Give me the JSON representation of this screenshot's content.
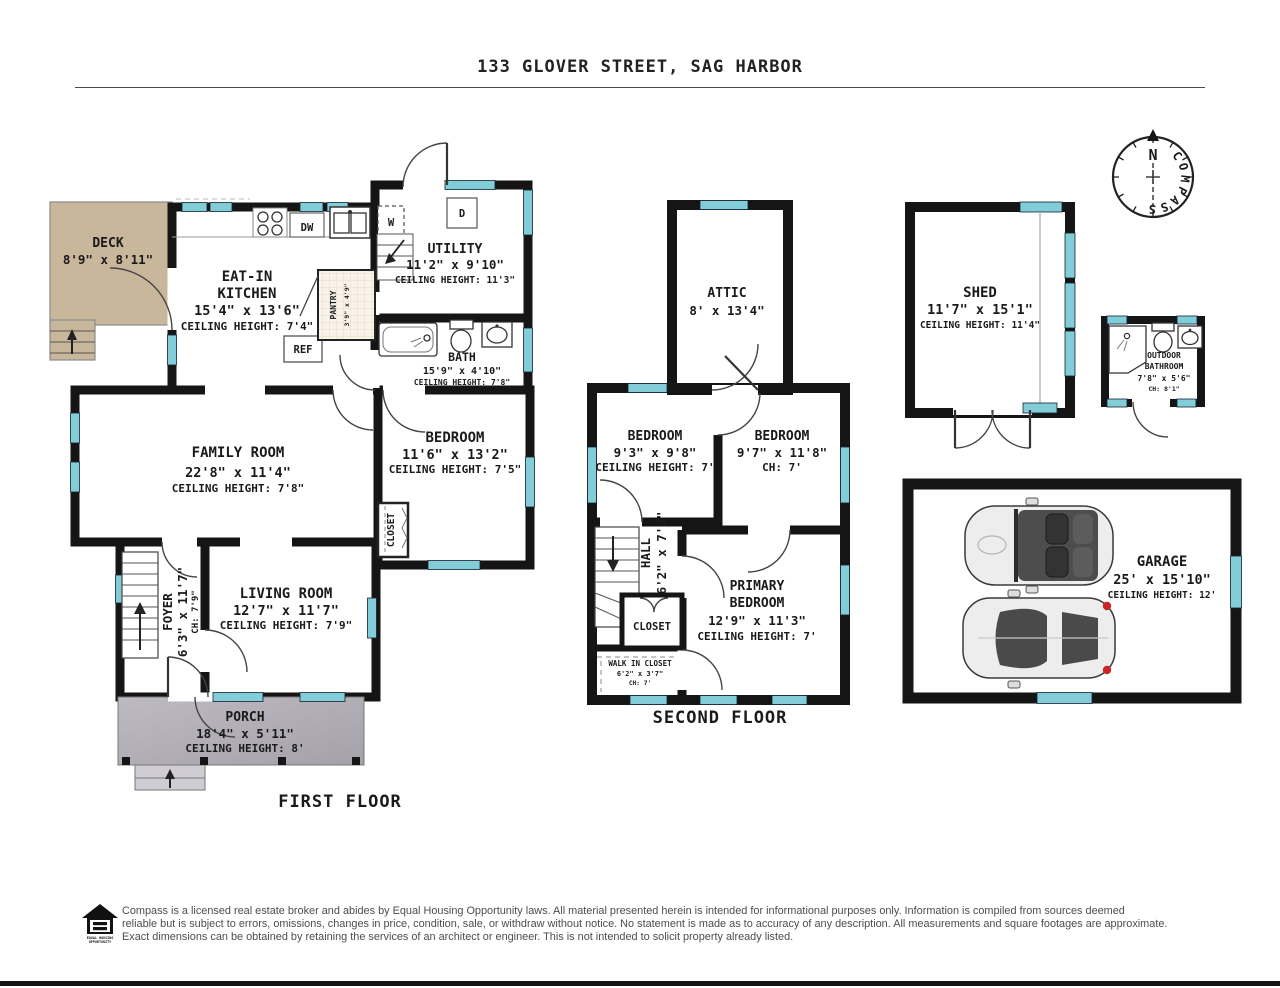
{
  "title": "133 GLOVER STREET, SAG HARBOR",
  "floor_labels": {
    "first": "FIRST FLOOR",
    "second": "SECOND FLOOR"
  },
  "rooms": {
    "deck": {
      "line1": "DECK",
      "line2": "8'9\" x 8'11\""
    },
    "kitchen": {
      "line1": "EAT-IN",
      "line2": "KITCHEN",
      "line3": "15'4\" x 13'6\"",
      "line4": "CEILING HEIGHT: 7'4\""
    },
    "utility": {
      "line1": "UTILITY",
      "line2": "11'2\" x 9'10\"",
      "line3": "CEILING HEIGHT: 11'3\""
    },
    "pantry": {
      "line1": "PANTRY",
      "line2": "3'9\" x 4'9\""
    },
    "bath": {
      "line1": "BATH",
      "line2": "15'9\" x 4'10\"",
      "line3": "CEILING HEIGHT: 7'8\""
    },
    "family_room": {
      "line1": "FAMILY ROOM",
      "line2": "22'8\" x 11'4\"",
      "line3": "CEILING HEIGHT: 7'8\""
    },
    "bedroom_first": {
      "line1": "BEDROOM",
      "line2": "11'6\" x 13'2\"",
      "line3": "CEILING HEIGHT: 7'5\""
    },
    "closet_first": {
      "line1": "CLOSET"
    },
    "foyer": {
      "line1": "FOYER",
      "line2": "6'3\" x 11'7\"",
      "line3": "CH: 7'9\""
    },
    "living_room": {
      "line1": "LIVING ROOM",
      "line2": "12'7\" x 11'7\"",
      "line3": "CEILING HEIGHT: 7'9\""
    },
    "porch": {
      "line1": "PORCH",
      "line2": "18'4\" x 5'11\"",
      "line3": "CEILING HEIGHT: 8'"
    },
    "attic": {
      "line1": "ATTIC",
      "line2": "8' x 13'4\""
    },
    "bedroom_left": {
      "line1": "BEDROOM",
      "line2": "9'3\" x 9'8\"",
      "line3": "CEILING HEIGHT: 7'"
    },
    "bedroom_right": {
      "line1": "BEDROOM",
      "line2": "9'7\" x 11'8\"",
      "line3": "CH: 7'"
    },
    "hall": {
      "line1": "HALL",
      "line2": "6'2\" x 7'3\""
    },
    "closet_second": {
      "line1": "CLOSET"
    },
    "walk_in_closet": {
      "line1": "WALK IN CLOSET",
      "line2": "6'2\" x 3'7\"",
      "line3": "CH: 7'"
    },
    "primary_bedroom": {
      "line1": "PRIMARY",
      "line2": "BEDROOM",
      "line3": "12'9\" x 11'3\"",
      "line4": "CEILING HEIGHT: 7'"
    },
    "shed": {
      "line1": "SHED",
      "line2": "11'7\" x 15'1\"",
      "line3": "CEILING HEIGHT: 11'4\""
    },
    "outdoor_bathroom": {
      "line1": "OUTDOOR",
      "line2": "BATHROOM",
      "line3": "7'8\" x 5'6\"",
      "line4": "CH: 8'1\""
    },
    "garage": {
      "line1": "GARAGE",
      "line2": "25' x 15'10\"",
      "line3": "CEILING HEIGHT: 12'"
    }
  },
  "appliances": {
    "washer": "W",
    "dryer": "D",
    "dishwasher": "DW",
    "refrigerator": "REF"
  },
  "compass": {
    "north": "N",
    "label": "COMPASS"
  },
  "footer": {
    "logo_line1": "EQUAL HOUSING",
    "logo_line2": "OPPORTUNITY",
    "disclaimer_line1": "Compass is a licensed real estate broker and abides by Equal Housing Opportunity laws. All material presented herein is intended for informational purposes only. Information is compiled from sources deemed",
    "disclaimer_line2": "reliable but is subject to errors, omissions, changes in price, condition, sale, or withdraw without notice. No statement is made as to accuracy of any description. All measurements and square footages are approximate.",
    "disclaimer_line3": "Exact dimensions can be obtained by retaining the services of an architect or engineer. This is not intended to solicit property already listed."
  },
  "colors": {
    "wall": "#151515",
    "window": "#82cdd8",
    "deck": "#c9b79c",
    "porch": "#b4b1b9",
    "tile_floor": "#f9f3ea",
    "north_red": "#d9342b",
    "taillight_red": "#cc2424"
  }
}
